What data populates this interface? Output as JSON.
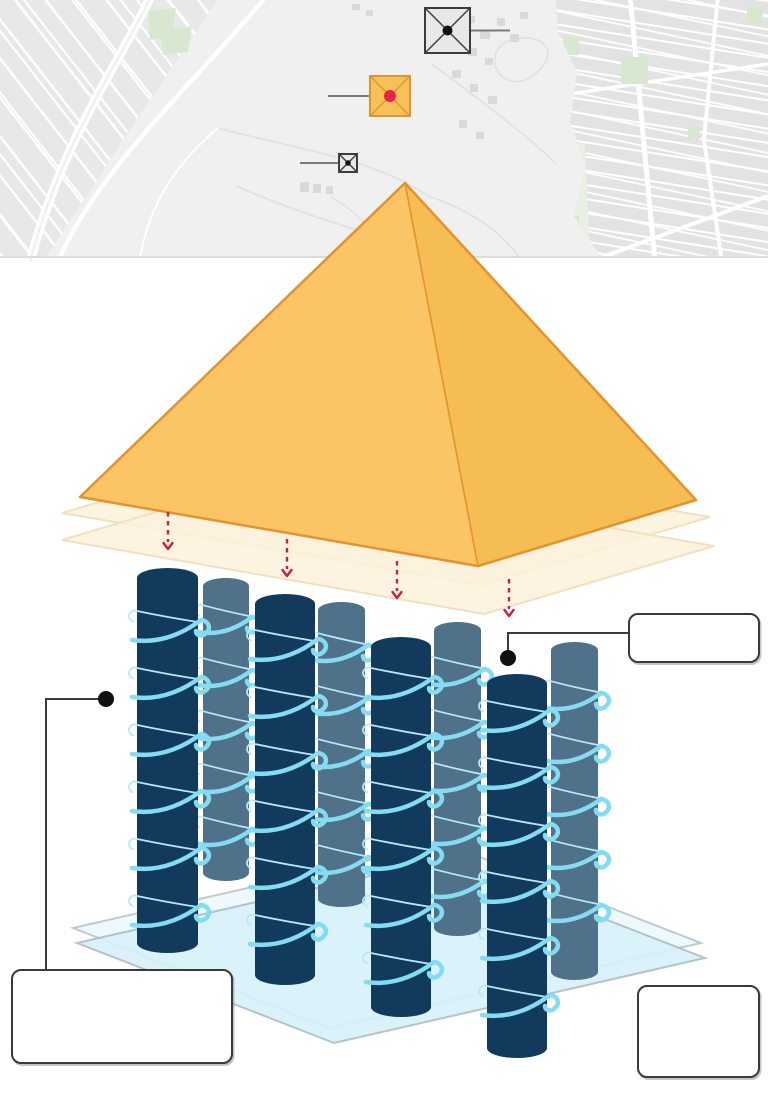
{
  "page": {
    "width": 768,
    "height": 1098
  },
  "colors": {
    "map-bg": "#F0F0F0",
    "map-parcel": "#E8E8E8",
    "map-city": "#E3E3E3",
    "map-road": "#FFFFFF",
    "map-trail": "#E2E2E2",
    "map-green": "#D7E7D0",
    "map-green-pale": "#E9EFE3",
    "map-building": "#D9D9D9",
    "map-border": "#DCDCDC",
    "marker-fill": "#E8E8E8",
    "marker-stroke": "#3C3C3C",
    "marker-hl-fill": "#F6C159",
    "marker-hl-stroke": "#E1932F",
    "marker-dot": "#111111",
    "marker-dot-red": "#E8234B",
    "leader": "#7A7A7A",
    "pyr-left": "#FBC566",
    "pyr-right": "#F7BD55",
    "pyr-stroke": "#E2932E",
    "slab-fill": "#FCF1DC",
    "slab-stroke": "#F2E0BE",
    "arrow": "#C42045",
    "col-dark": "#113A5C",
    "col-light": "#50718A",
    "coil": "#84DBF2",
    "coil-thin": "#B5E9F7",
    "plat-front": "#D7F1F9",
    "plat-back": "#EAF8FC",
    "plat-stroke": "#A9B4BB",
    "callout": "#3A3A3A",
    "callout-dot": "#111111",
    "box-border": "#3A3A3C",
    "box-bg": "#FFFFFF"
  },
  "map": {
    "markers": [
      {
        "id": "pyramid-north",
        "style": "plain",
        "x": 425,
        "y": 8,
        "size": 45,
        "dot_r": 5,
        "leader": {
          "dir": "right",
          "len": 40
        }
      },
      {
        "id": "pyramid-highlighted",
        "style": "highlight",
        "x": 370,
        "y": 76,
        "size": 40,
        "dot_r": 6,
        "leader": {
          "dir": "left",
          "len": 42
        }
      },
      {
        "id": "pyramid-south",
        "style": "plain",
        "x": 339,
        "y": 154,
        "size": 18,
        "dot_r": 2.8,
        "leader": {
          "dir": "left",
          "len": 39
        }
      }
    ]
  },
  "pyramid": {
    "apex": [
      405,
      183
    ],
    "left": [
      80,
      497
    ],
    "front": [
      478,
      566
    ],
    "right": [
      696,
      500
    ]
  },
  "slabs": {
    "items": [
      {
        "points": "62,513 290,445 710,517 482,585"
      },
      {
        "points": "62,540 290,472 714,546 484,614"
      }
    ]
  },
  "arrows": {
    "items": [
      {
        "x": 168,
        "y1": 512,
        "y2": 549
      },
      {
        "x": 287,
        "y1": 539,
        "y2": 576
      },
      {
        "x": 397,
        "y1": 561,
        "y2": 598
      },
      {
        "x": 509,
        "y1": 579,
        "y2": 616
      }
    ]
  },
  "platform": {
    "back": "73,928 444,843 701,943 330,1028",
    "front": "77,943 448,858 705,958 334,1043"
  },
  "columns": {
    "items": [
      {
        "x": 137,
        "w": 61,
        "top": 578,
        "bottom": 943,
        "tone": "dark",
        "phase": 62
      },
      {
        "x": 203,
        "w": 46,
        "top": 586,
        "bottom": 873,
        "tone": "light",
        "phase": 46
      },
      {
        "x": 255,
        "w": 60,
        "top": 604,
        "bottom": 975,
        "tone": "dark",
        "phase": 55
      },
      {
        "x": 318,
        "w": 47,
        "top": 610,
        "bottom": 899,
        "tone": "light",
        "phase": 50
      },
      {
        "x": 371,
        "w": 60,
        "top": 647,
        "bottom": 1007,
        "tone": "dark",
        "phase": 50
      },
      {
        "x": 434,
        "w": 47,
        "top": 630,
        "bottom": 928,
        "tone": "light",
        "phase": 54
      },
      {
        "x": 487,
        "w": 60,
        "top": 684,
        "bottom": 1048,
        "tone": "dark",
        "phase": 46
      },
      {
        "x": 551,
        "w": 47,
        "top": 650,
        "bottom": 972,
        "tone": "light",
        "phase": 58
      }
    ]
  },
  "callouts": {
    "items": [
      {
        "id": "right",
        "label": "",
        "box": [
          628,
          613,
          132,
          50
        ],
        "dot": [
          508,
          658
        ],
        "path": "M 508 658 L 508 633 L 628 633"
      },
      {
        "id": "left",
        "label": "",
        "box": [
          11,
          969,
          222,
          95
        ],
        "dot": [
          106,
          699
        ],
        "path": "M 106 699 L 46 699 L 46 969"
      },
      {
        "id": "bottom-right",
        "label": "",
        "box": [
          637,
          985,
          123,
          93
        ]
      }
    ]
  }
}
